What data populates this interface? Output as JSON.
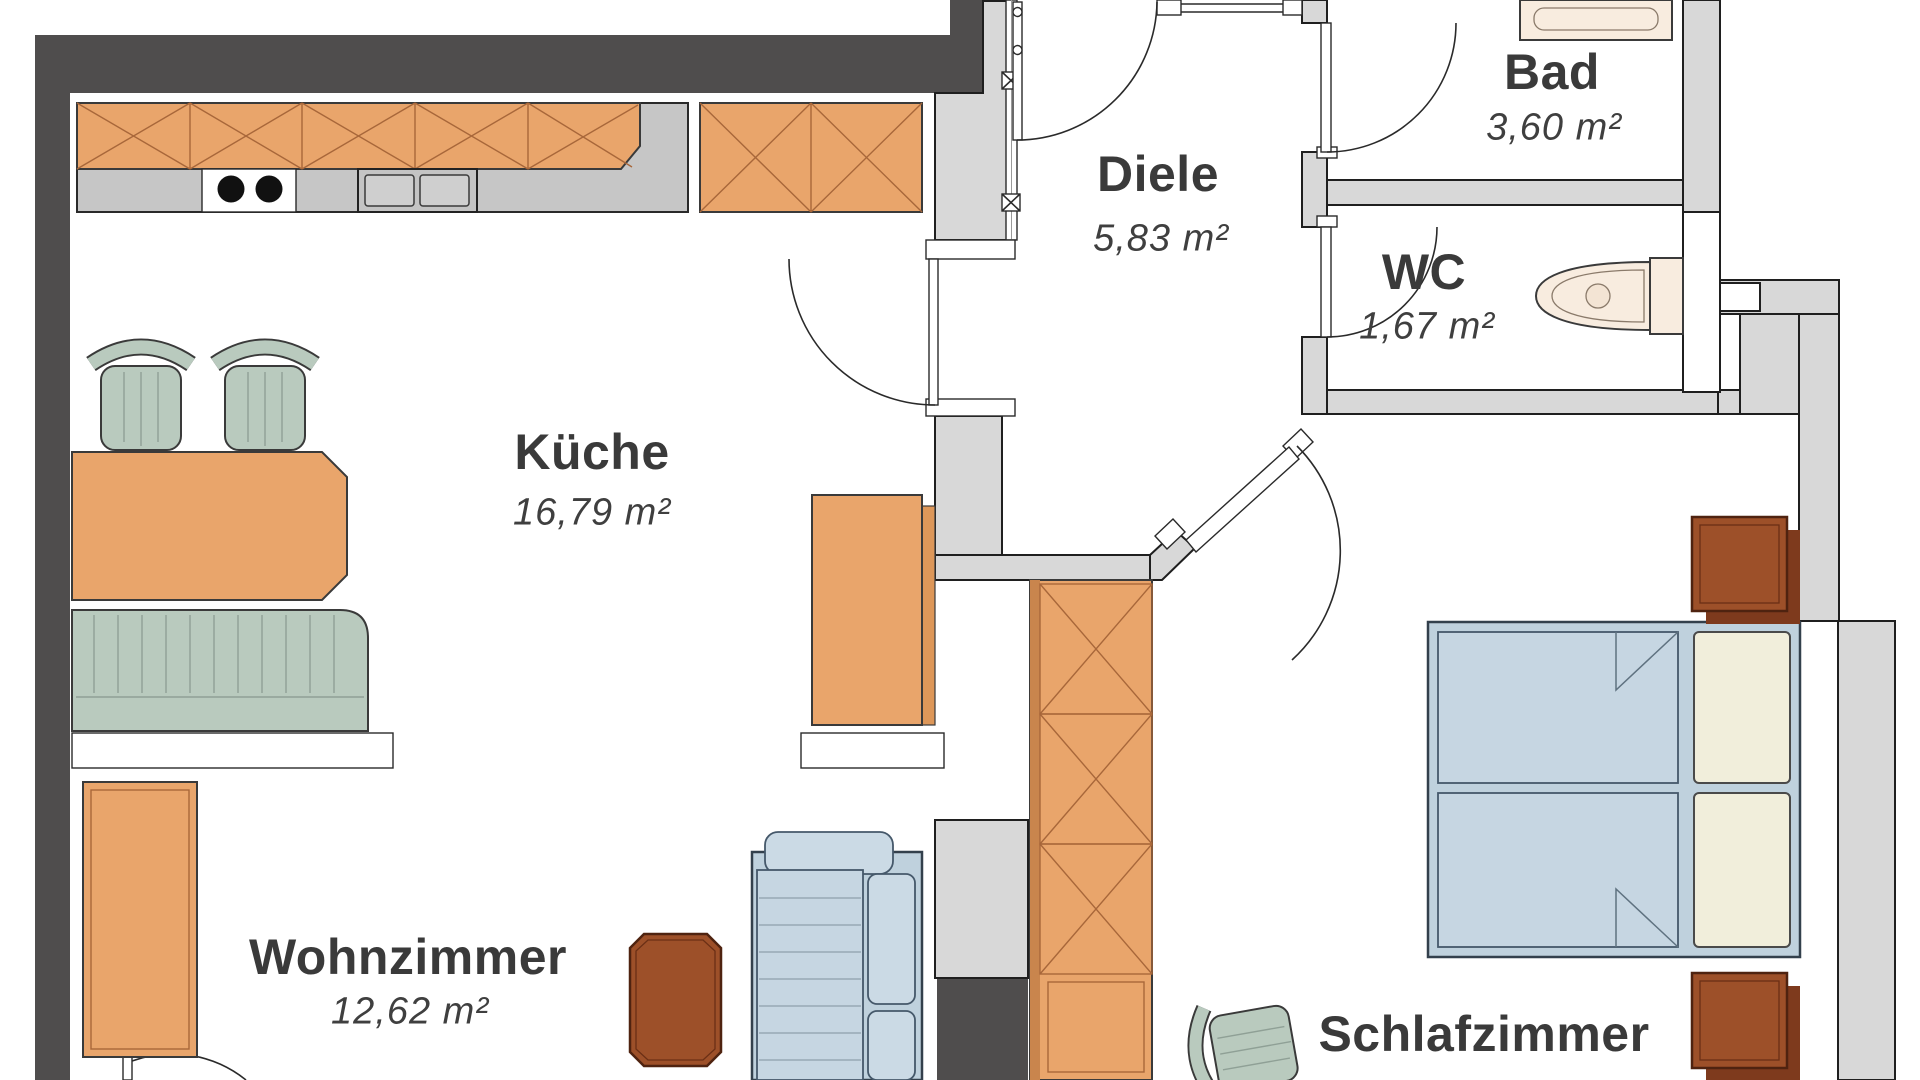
{
  "floorplan": {
    "type": "apartment-floor-plan",
    "rooms": [
      {
        "name": "Küche",
        "area": "16,79 m²"
      },
      {
        "name": "Diele",
        "area": "5,83 m²"
      },
      {
        "name": "Bad",
        "area": "3,60 m²"
      },
      {
        "name": "WC",
        "area": "1,67 m²"
      },
      {
        "name": "Wohnzimmer",
        "area": "12,62 m²"
      },
      {
        "name": "Schlafzimmer",
        "area": "15,77 m²"
      }
    ],
    "furniture": [
      "kitchen-counter",
      "cooktop",
      "sink",
      "wall-cabinet",
      "tall-cabinet",
      "dining-table",
      "dining-chairs",
      "kitchen-bench",
      "console-shelves",
      "sideboard",
      "coffee-table",
      "sofa",
      "wardrobe",
      "desk-chair",
      "double-bed",
      "pillows",
      "nightstands",
      "vanity-basin",
      "toilet"
    ],
    "colors": {
      "wall_dark": "#4F4D4D",
      "wall_light": "#D8D8D8",
      "wood": "#E9A56B",
      "wood_dark": "#9D5029",
      "sage": "#B9CABE",
      "blue": "#C6D6E2",
      "cream": "#F1EEDB",
      "fixture": "#F8ECDF",
      "text": "#3A3A3A"
    }
  }
}
